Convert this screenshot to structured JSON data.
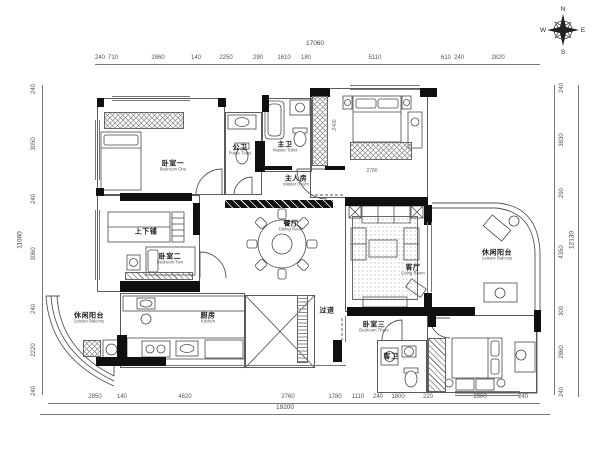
{
  "compass": {
    "n": "N",
    "e": "E",
    "s": "S",
    "w": "W"
  },
  "dimensions": {
    "top": {
      "overall": "17060",
      "segments": [
        "240",
        "710",
        "2860",
        "140",
        "2250",
        "290",
        "1610",
        "180",
        "5110",
        "610",
        "240",
        "2820"
      ]
    },
    "bottom": {
      "overall": "19200",
      "segments": [
        "2850",
        "140",
        "4620",
        "2760",
        "1780",
        "1110",
        "240",
        "1800",
        "220",
        "2960",
        "240"
      ]
    },
    "left": {
      "overall": "11060",
      "segments": [
        "240",
        "3050",
        "240",
        "3060",
        "240",
        "2220",
        "240"
      ]
    },
    "right": {
      "overall": "12130",
      "segments": [
        "240",
        "3830",
        "290",
        "4350",
        "300",
        "2860",
        "240"
      ]
    }
  },
  "interior_dims": {
    "master_wardrobe": "2780",
    "closet_strip": "2400"
  },
  "rooms": {
    "bedroom_one": {
      "zh": "卧室一",
      "en": "Bedroom One"
    },
    "public_toilet": {
      "zh": "公卫",
      "en": "Public Toilet"
    },
    "master_toilet": {
      "zh": "主卫",
      "en": "Master Toilet"
    },
    "master_room": {
      "zh": "主人房",
      "en": "Master Room"
    },
    "dining_room": {
      "zh": "餐厅",
      "en": "Dining Room"
    },
    "living_room": {
      "zh": "客厅",
      "en": "Living Room"
    },
    "balcony_right": {
      "zh": "休闲阳台",
      "en": "Leisure Balcony"
    },
    "bunk_bed": {
      "zh": "上下铺",
      "en": ""
    },
    "bedroom_two": {
      "zh": "卧室二",
      "en": "Bedroom Two"
    },
    "balcony_left": {
      "zh": "休闲阳台",
      "en": "Leisure Balcony"
    },
    "kitchen": {
      "zh": "厨房",
      "en": "Kitchen"
    },
    "hallway": {
      "zh": "过道",
      "en": ""
    },
    "bedroom_three": {
      "zh": "卧室三",
      "en": "Bedroom Three"
    },
    "guest_toilet": {
      "zh": "客卫",
      "en": ""
    }
  },
  "colors": {
    "wall": "#101010",
    "line": "#5a5a5a",
    "dim_text": "#555555",
    "paper": "#ffffff"
  }
}
